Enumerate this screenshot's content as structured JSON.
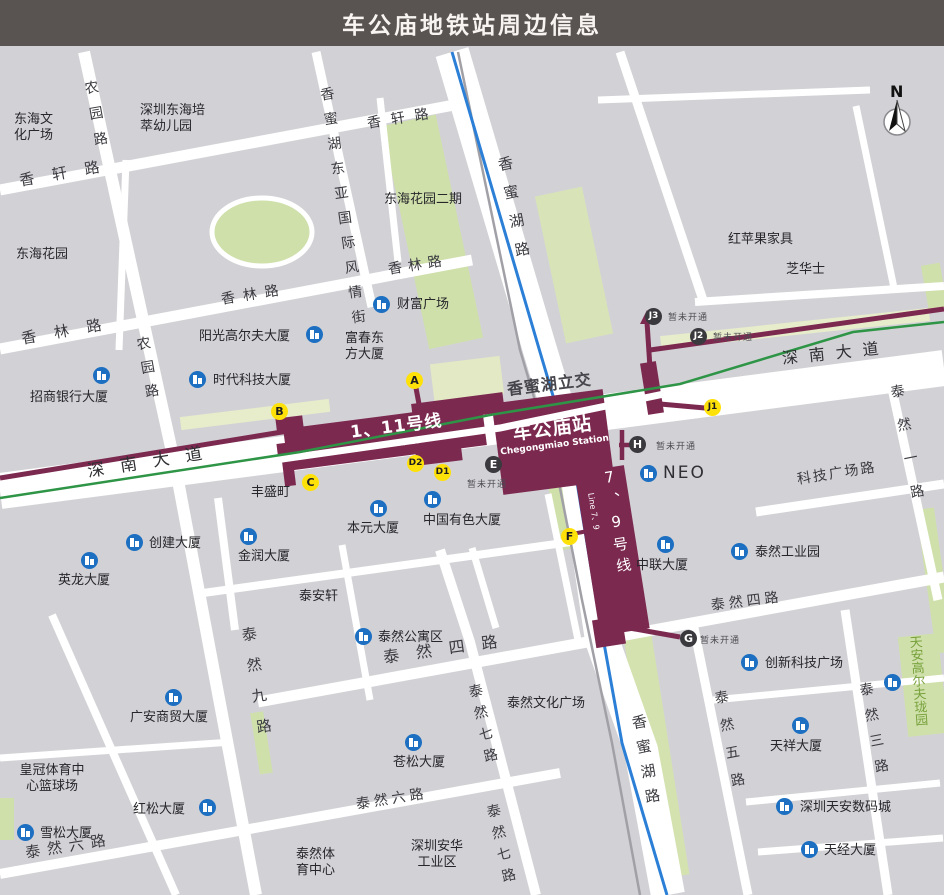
{
  "title": "车公庙地铁站周边信息",
  "compass": "N",
  "station": {
    "name": "车公庙站",
    "name_en": "Chegongmiao Station",
    "line_1_11": "1、11号线",
    "line_1_11_en": "Line 1、11",
    "line_7_9": "7、9号线",
    "line_7_9_en": "Line 7、9",
    "interchange_label": "香蜜湖立交",
    "not_open_label": "暂未开通"
  },
  "exits": {
    "a": "A",
    "b": "B",
    "c": "C",
    "d1": "D1",
    "d2": "D2",
    "e": "E",
    "f": "F",
    "g": "G",
    "h": "H",
    "j1": "J1",
    "j2": "J2",
    "j3": "J3"
  },
  "roads": {
    "shennan_avenue": "深南大道",
    "xiangmihu_road": "香蜜湖路",
    "xiangxuan_road": "香轩路",
    "xianglin_road": "香林路",
    "nongyuan_road": "农园路",
    "fengqing_street": "香蜜湖东亚国际风情街",
    "tairan_1": "泰然一路",
    "tairan_3": "泰然三路",
    "tairan_4": "泰然四路",
    "tairan_5": "泰然五路",
    "tairan_6": "泰然六路",
    "tairan_7": "泰然七路",
    "tairan_9": "泰然九路",
    "keji_plaza_road": "科技广场路"
  },
  "places": {
    "donghai_culture_plaza": "东海文\n化广场",
    "donghai_kindergarten": "深圳东海培\n萃幼儿园",
    "donghai_garden": "东海花园",
    "donghai_garden_phase2": "东海花园二期",
    "redapple_furniture": "红苹果家具",
    "chivas": "芝华士",
    "fortune_plaza": "财富广场",
    "sunshine_golf_building": "阳光高尔夫大厦",
    "fuchun_oriental_building": "富春东\n方大厦",
    "times_tech_building": "时代科技大厦",
    "cmb_building": "招商银行大厦",
    "fengshengding": "丰盛町",
    "chuangjian_building": "创建大厦",
    "yinglong_building": "英龙大厦",
    "jinrun_building": "金润大厦",
    "benyuan_building": "本元大厦",
    "china_nonferrous_building": "中国有色大厦",
    "taianxuan": "泰安轩",
    "tairan_apartments": "泰然公寓区",
    "guangan_trade_building": "广安商贸大厦",
    "crown_sports_center": "皇冠体育中\n心篮球场",
    "hongsong_building": "红松大厦",
    "xuesong_building": "雪松大厦",
    "cangsong_building": "苍松大厦",
    "anhua_industrial_zone": "深圳安华\n工业区",
    "tairan_sports_center": "泰然体\n育中心",
    "tairan_culture_plaza": "泰然文化广场",
    "tairan_industrial_park": "泰然工业园",
    "zhonglian_building": "中联大厦",
    "neo": "NEO",
    "innovation_tech_plaza": "创新科技广场",
    "tianxiang_building": "天祥大厦",
    "tianan_digital_city": "深圳天安数码城",
    "tianjing_building": "天经大厦",
    "tianan_golf_longyuan": "天安高尔夫珑园"
  }
}
